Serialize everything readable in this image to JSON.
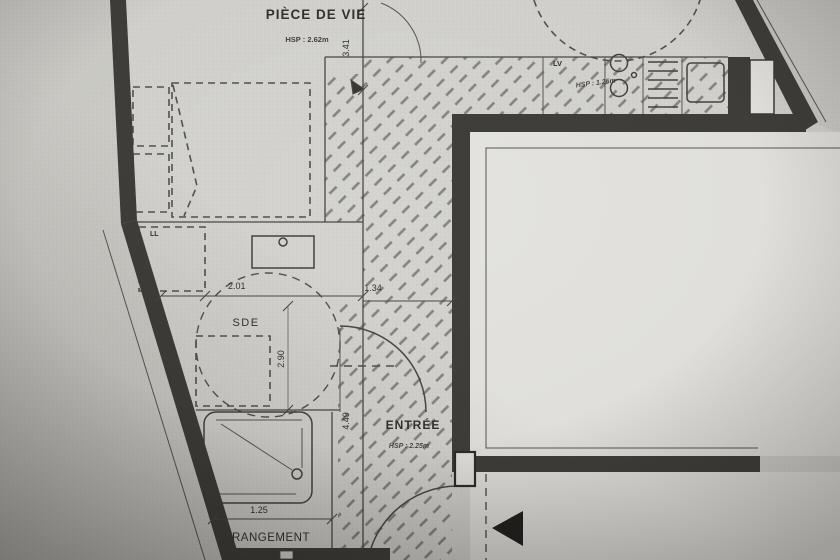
{
  "plan": {
    "rooms": {
      "piece_de_vie": {
        "label": "PIÈCE DE VIE",
        "hsp": "HSP : 2.62m"
      },
      "kitchen": {
        "lv_label": "LV",
        "hsp": "HSP : 1.25m"
      },
      "sde": {
        "label": "SDE",
        "ll_label": "LL"
      },
      "entree": {
        "label": "ENTRÉE",
        "hsp": "HSP : 2.25m"
      },
      "rangement": {
        "label": "RANGEMENT"
      }
    },
    "dimensions": {
      "living_width": "3.41",
      "sde_width": "2.01",
      "hall_width": "1.34",
      "sde_length": "2.90",
      "hall_length": "4.49",
      "rangement_width": "1.25"
    },
    "colors": {
      "wall": "#403e3a",
      "paper": "#d5d4d0",
      "outside": "#cecdc8",
      "indent": "#e4e3df",
      "arrow": "#22201d",
      "text": "#343230"
    }
  }
}
